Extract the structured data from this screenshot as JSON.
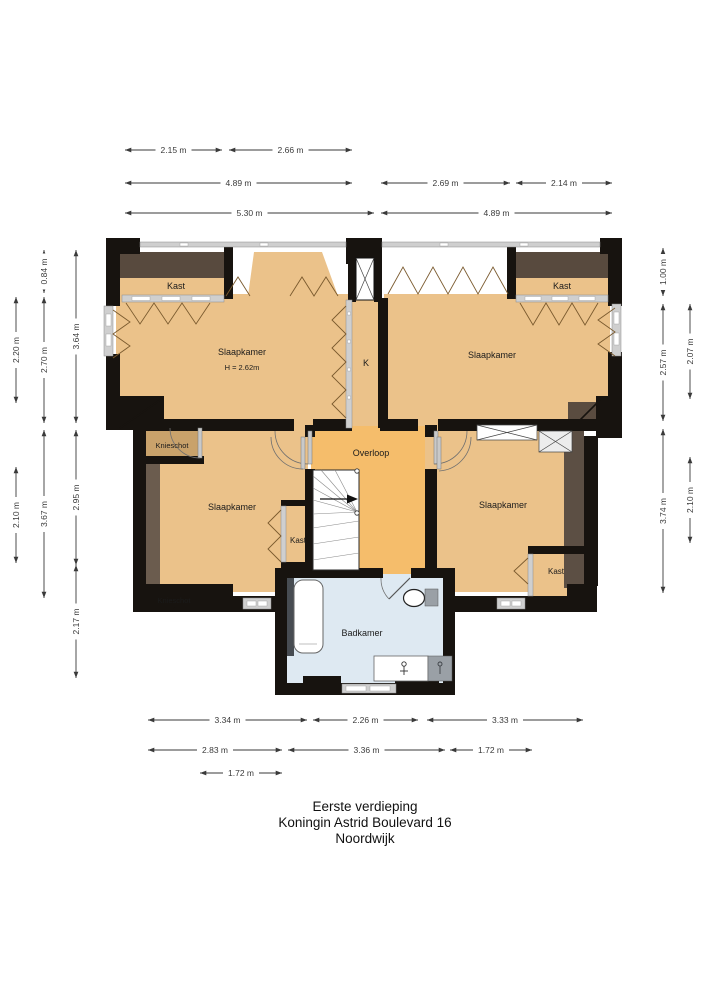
{
  "title": {
    "line1": "Eerste verdieping",
    "line2": "Koningin Astrid Boulevard 16",
    "line3": "Noordwijk"
  },
  "rooms": {
    "slaapkamer_tl": {
      "label": "Slaapkamer",
      "height_note": "H = 2.62m"
    },
    "slaapkamer_tr": {
      "label": "Slaapkamer"
    },
    "slaapkamer_bl": {
      "label": "Slaapkamer"
    },
    "slaapkamer_br": {
      "label": "Slaapkamer"
    },
    "kast_tl": {
      "label": "Kast"
    },
    "kast_tr": {
      "label": "Kast"
    },
    "kast_mid": {
      "label": "Kast"
    },
    "kast_br": {
      "label": "Kast"
    },
    "k": {
      "label": "K"
    },
    "overloop": {
      "label": "Overloop"
    },
    "badkamer": {
      "label": "Badkamer"
    },
    "knieschot_top": {
      "label": "Knieschot"
    },
    "knieschot_bottom": {
      "label": "Knieschot"
    }
  },
  "dimensions": {
    "top": {
      "r1a": "2.15 m",
      "r1b": "2.66 m",
      "r2a": "4.89 m",
      "r2b": "2.69 m",
      "r2c": "2.14 m",
      "r3a": "5.30 m",
      "r3b": "4.89 m"
    },
    "left": {
      "c1a": "2.20 m",
      "c1b": "2.10 m",
      "c2a": "0.84 m",
      "c2b": "2.70 m",
      "c2c": "3.67 m",
      "c3a": "3.64 m",
      "c3b": "2.95 m",
      "c3c": "2.17 m"
    },
    "right": {
      "c1a": "1.00 m",
      "c1b": "2.57 m",
      "c1c": "3.74 m",
      "c2a": "2.07 m",
      "c2b": "2.10 m"
    },
    "bottom": {
      "r1a": "3.34 m",
      "r1b": "2.26 m",
      "r1c": "3.33 m",
      "r2a": "2.83 m",
      "r2b": "3.36 m",
      "r2c": "1.72 m",
      "r3a": "1.72 m"
    }
  },
  "colors": {
    "wall": "#17130f",
    "bedroom_tan": "#ebc28a",
    "landing_orange": "#f5bd6b",
    "bath_blue": "#dee9f2",
    "kast_dark_brown": "#584a3e",
    "knieschot_brown": "#6b5c4e",
    "knieschot_light": "#c9a26b",
    "window_gray": "#cfcfcf"
  }
}
